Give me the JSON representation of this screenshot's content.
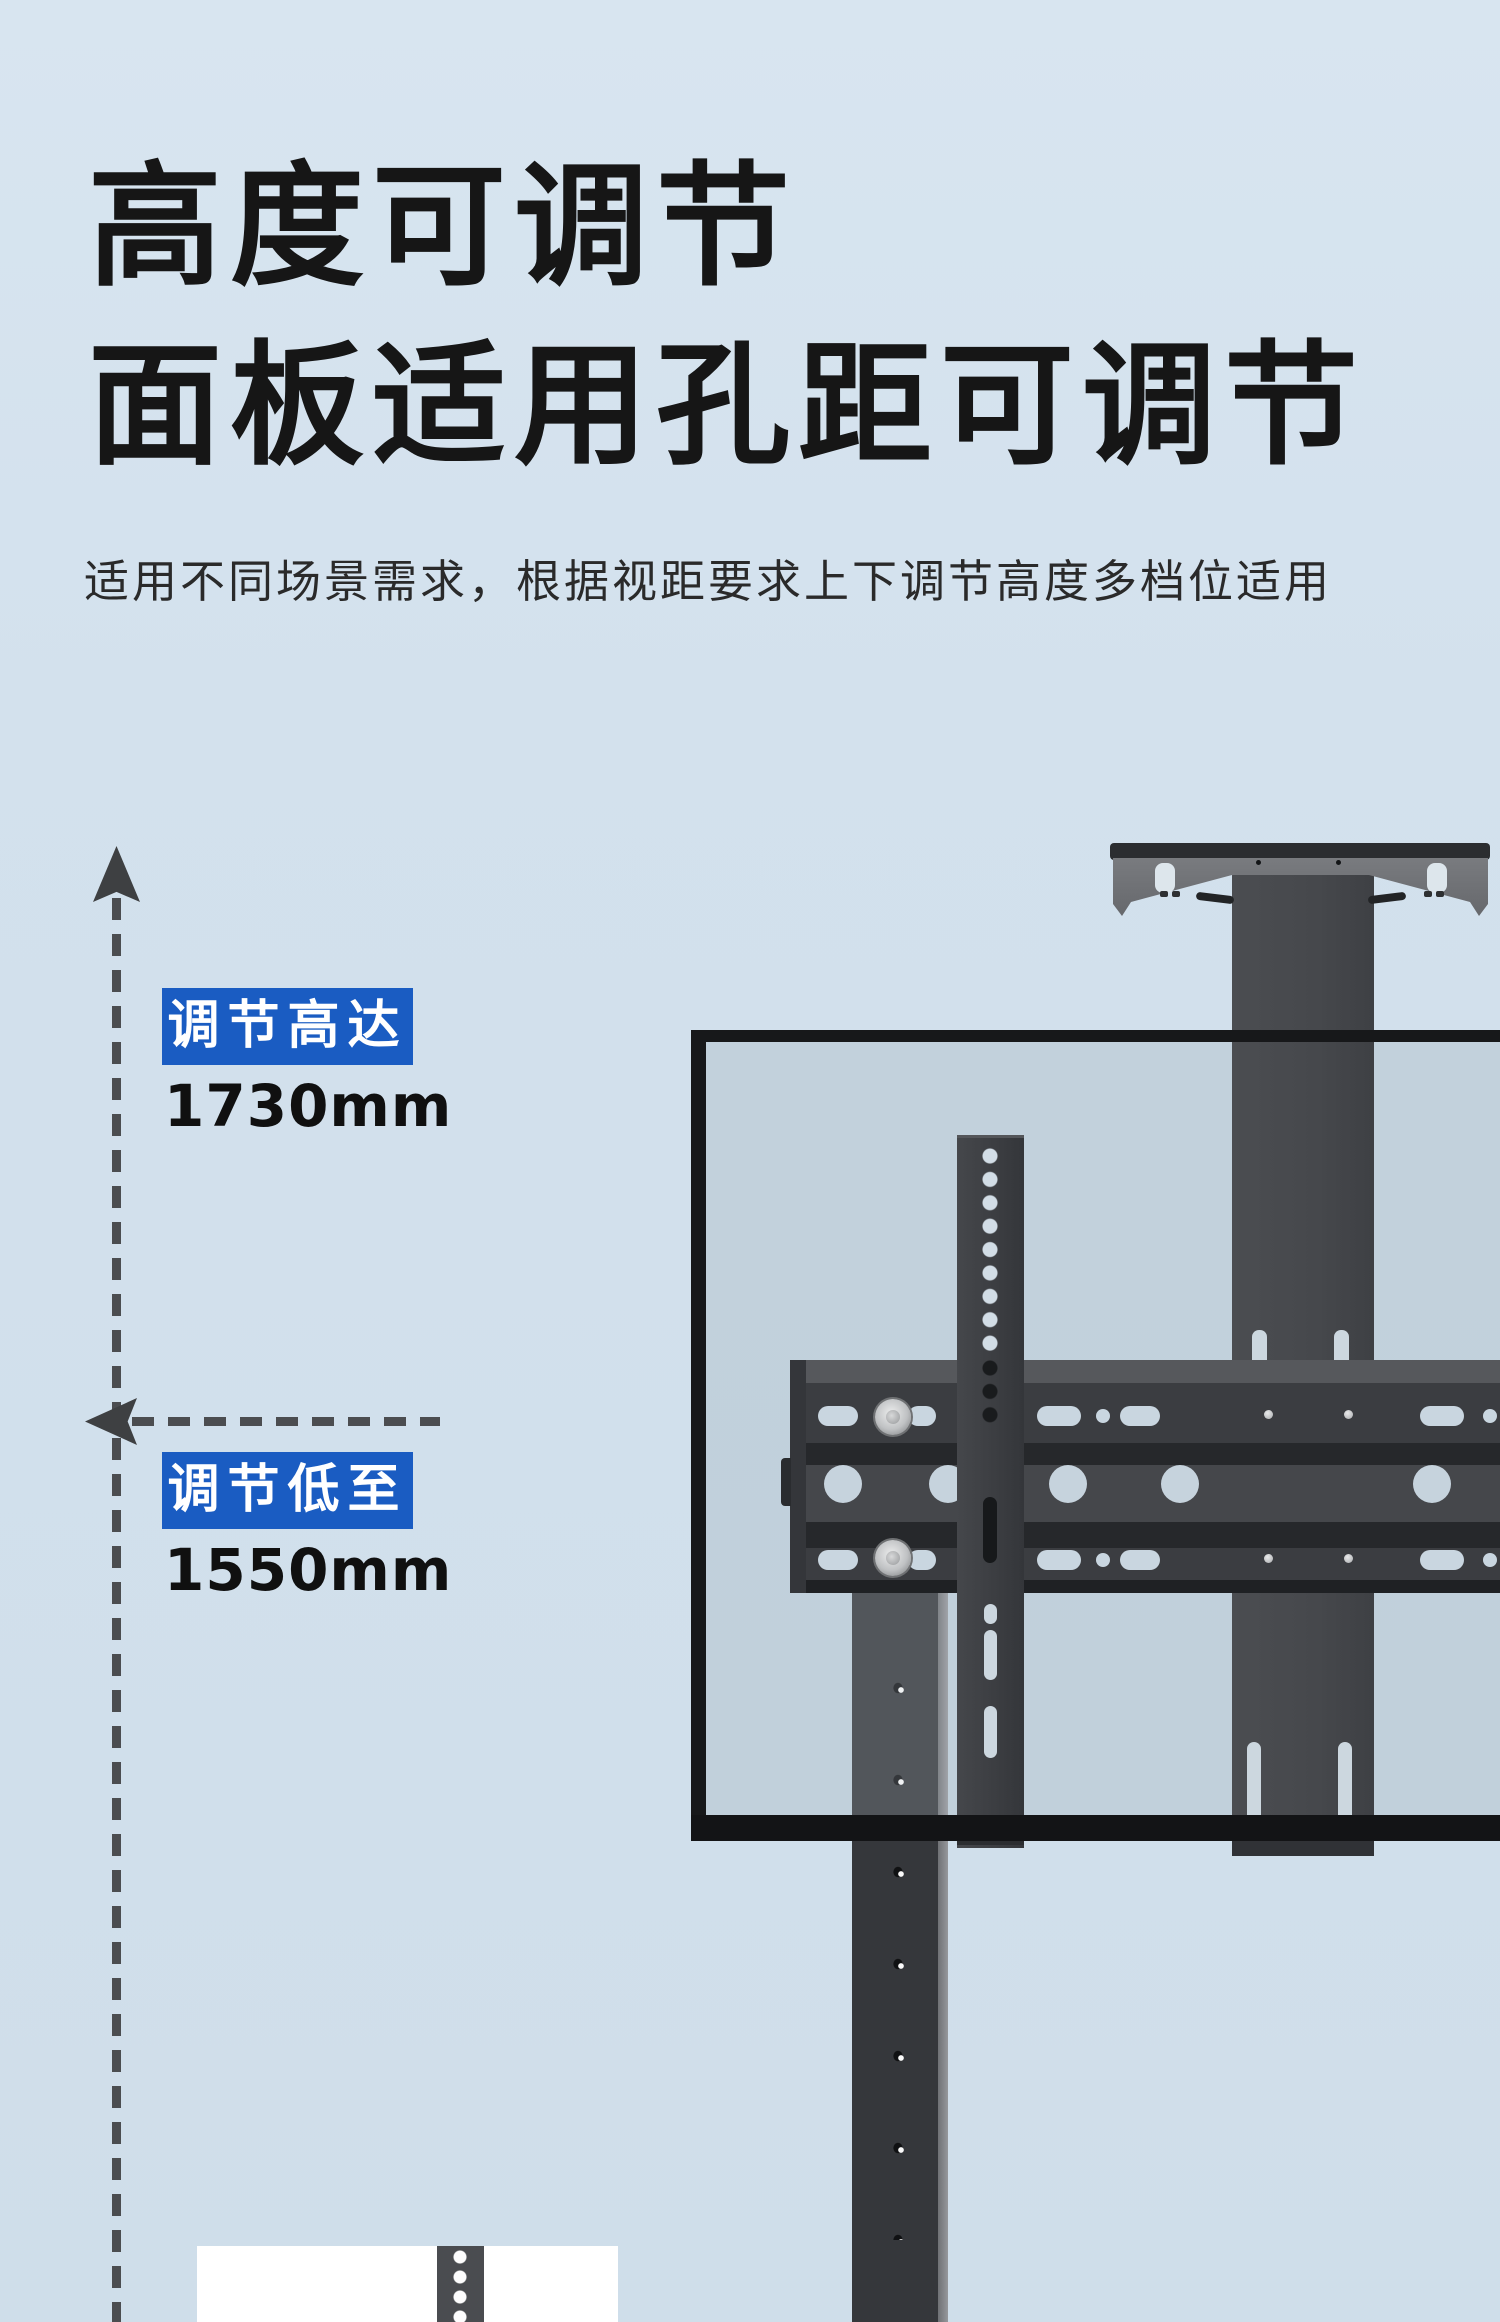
{
  "header": {
    "title_line1": "高度可调节",
    "title_line2": "面板适用孔距可调节",
    "subtitle": "适用不同场景需求，根据视距要求上下调节高度多档位适用"
  },
  "annotations": {
    "max_height": {
      "badge": "调节高达",
      "value": "1730mm"
    },
    "min_height": {
      "badge": "调节低至",
      "value": "1550mm"
    }
  },
  "colors": {
    "accent_blue": "#1a5cc2",
    "background": "#d3e1ed",
    "metal_dark": "#3b3d41",
    "panel_border": "#17181a"
  }
}
